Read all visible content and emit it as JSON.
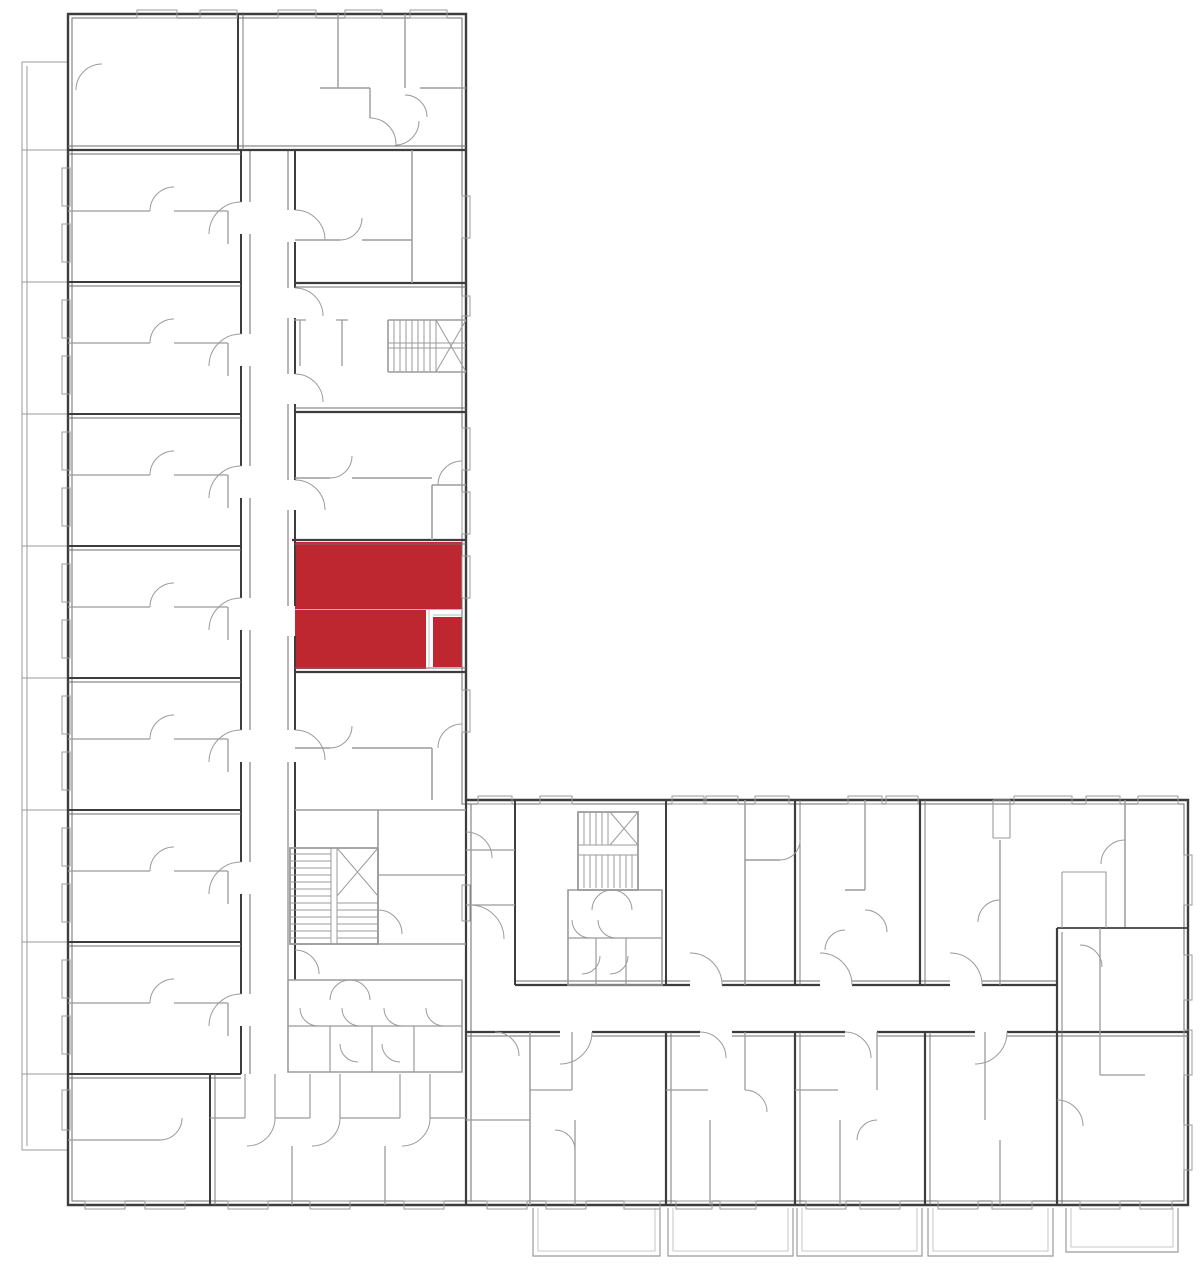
{
  "document": {
    "kind": "architectural-floor-plan",
    "description": "L-shaped residential building floor plan, line drawing, one apartment unit highlighted in red",
    "visible_text": []
  },
  "palette": {
    "background": "#ffffff",
    "wall_dark": "#3d3d3d",
    "wall_medium": "#6e6e6e",
    "line_light": "#9b9b9b",
    "line_faint": "#b9b9b9",
    "highlight": "#be272f"
  },
  "highlighted_unit": {
    "name": "selected-apartment",
    "fill": "#be272f",
    "rects": [
      {
        "x": 295,
        "y": 542,
        "w": 167,
        "h": 67
      },
      {
        "x": 295,
        "y": 610,
        "w": 131,
        "h": 59
      },
      {
        "x": 433,
        "y": 617,
        "w": 29,
        "h": 50
      }
    ]
  },
  "canvas": {
    "width": 1200,
    "height": 1270
  }
}
